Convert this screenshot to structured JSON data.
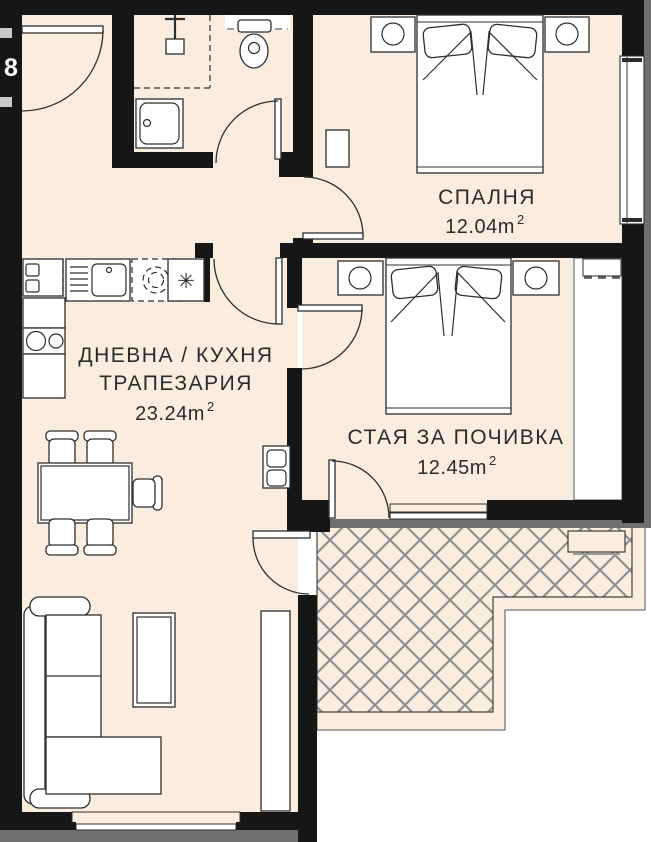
{
  "floor_plan": {
    "unit_number": "8",
    "colors": {
      "floor": "#FAEDE0",
      "wall": "#161616",
      "railing_gray": "#6f6f6f",
      "hatch_gray": "#8f8f8f",
      "text": "#2b2b2b"
    },
    "rooms": {
      "bedroom": {
        "label": "СПАЛНЯ",
        "area_value": "12.04m",
        "area_exponent": "2"
      },
      "living_kitchen": {
        "label_line1": "ДНЕВНА / КУХНЯ",
        "label_line2": "ТРАПЕЗАРИЯ",
        "area_value": "23.24m",
        "area_exponent": "2"
      },
      "rest_room": {
        "label": "СТАЯ ЗА ПОЧИВКА",
        "area_value": "12.45m",
        "area_exponent": "2"
      }
    },
    "kitchen": {
      "fridge_symbol": "✳"
    }
  }
}
